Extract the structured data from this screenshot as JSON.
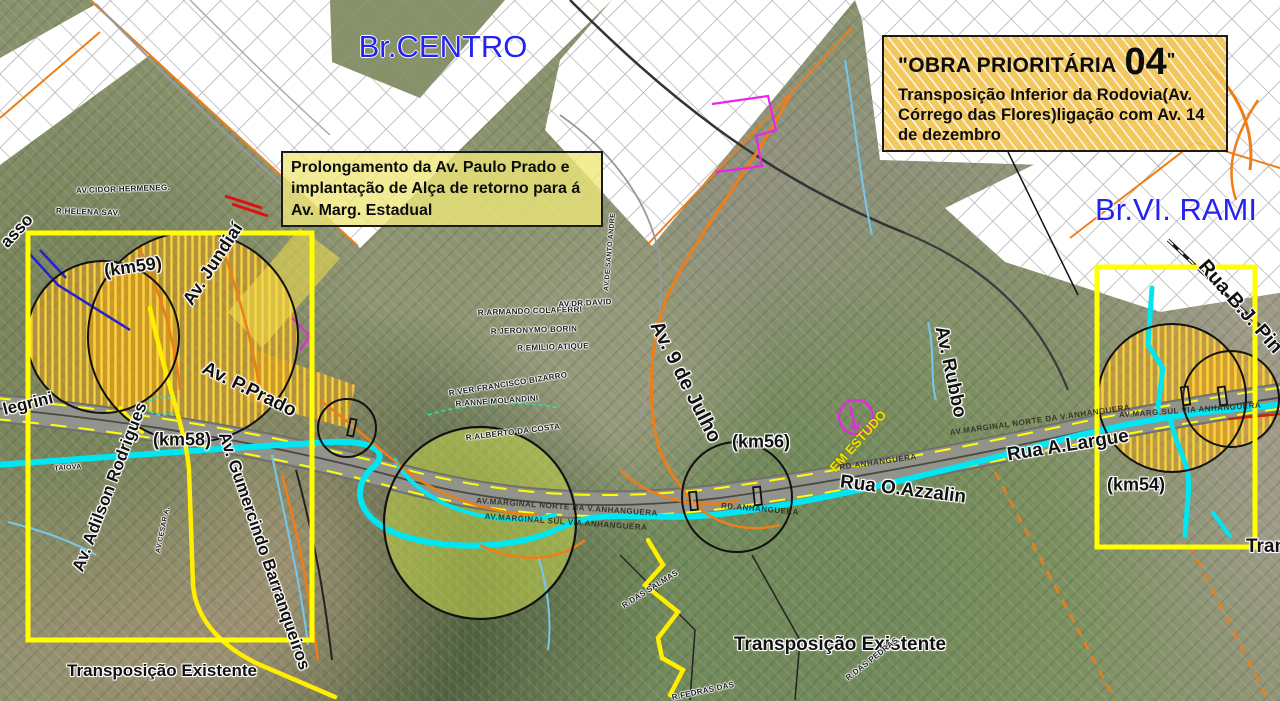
{
  "map": {
    "callouts": {
      "obra04": {
        "title_prefix": "\"OBRA PRIORITÁRIA",
        "number": "04",
        "title_suffix": "\"",
        "body": "Transposição Inferior da Rodovia(Av. Córrego das Flores)ligação com Av. 14 de dezembro"
      },
      "prolongamento": {
        "body": "Prolongamento da Av. Paulo Prado e implantação de Alça de retorno para á Av. Marg. Estadual"
      }
    },
    "labels": [
      {
        "name": "region-label-centro",
        "text": "Br.CENTRO",
        "x": 443,
        "y": 47,
        "rot": 0,
        "size": 31,
        "color": "#2424ee",
        "cls": "region"
      },
      {
        "name": "region-label-vila-rami",
        "text": "Br.VI. RAMI",
        "x": 1176,
        "y": 210,
        "rot": 0,
        "size": 31,
        "color": "#2424ee",
        "cls": "region"
      },
      {
        "name": "road-label-av-jundiai",
        "text": "Av. Jundiaí",
        "x": 213,
        "y": 264,
        "rot": -57,
        "size": 18
      },
      {
        "name": "km-marker-59",
        "text": "(km59)",
        "x": 133,
        "y": 267,
        "rot": -8,
        "size": 18
      },
      {
        "name": "km-marker-58",
        "text": "(km58)",
        "x": 182,
        "y": 440,
        "rot": 0,
        "size": 18
      },
      {
        "name": "road-label-av-p-prado",
        "text": "Av. P.Prado",
        "x": 249,
        "y": 390,
        "rot": 26,
        "size": 19
      },
      {
        "name": "road-label-av-adilson-rodrigues",
        "text": "Av. Adilson Rodrigues",
        "x": 110,
        "y": 487,
        "rot": -69,
        "size": 17
      },
      {
        "name": "road-label-av-gumercindo-barranqueiros",
        "text": "Av. Gumercindo Barranqueiros",
        "x": 264,
        "y": 551,
        "rot": 71,
        "size": 17
      },
      {
        "name": "note-transposicao-existente-left",
        "text": "Transposição Existente",
        "x": 162,
        "y": 671,
        "rot": 0,
        "size": 17
      },
      {
        "name": "road-label-av-9-de-julho",
        "text": "Av. 9 de Julho",
        "x": 685,
        "y": 382,
        "rot": 63,
        "size": 20
      },
      {
        "name": "km-marker-56",
        "text": "(km56)",
        "x": 761,
        "y": 442,
        "rot": 0,
        "size": 18
      },
      {
        "name": "note-em-estudo",
        "text": "EM ESTUDO",
        "x": 858,
        "y": 441,
        "rot": -48,
        "size": 13,
        "color": "#f2e400",
        "cls": "on-dark"
      },
      {
        "name": "road-label-av-rubbo",
        "text": "Av. Rubbo",
        "x": 950,
        "y": 372,
        "rot": 78,
        "size": 19
      },
      {
        "name": "road-label-rua-o-azzalin",
        "text": "Rua O.Azzalin",
        "x": 903,
        "y": 490,
        "rot": 7,
        "size": 19
      },
      {
        "name": "road-label-rua-a-largue",
        "text": "Rua A.Largue",
        "x": 1068,
        "y": 446,
        "rot": -9,
        "size": 19
      },
      {
        "name": "km-marker-54",
        "text": "(km54)",
        "x": 1136,
        "y": 485,
        "rot": 0,
        "size": 18
      },
      {
        "name": "road-label-rua-bj-pin",
        "text": "Rua B.J. Pin",
        "x": 1240,
        "y": 307,
        "rot": 49,
        "size": 20
      },
      {
        "name": "note-transposicao-existente-center",
        "text": "Transposição Existente",
        "x": 840,
        "y": 645,
        "rot": 0,
        "size": 19
      },
      {
        "name": "note-transposicao-right-clipped",
        "text": "Tran",
        "x": 1266,
        "y": 547,
        "rot": 0,
        "size": 19
      },
      {
        "name": "edge-label-asso",
        "text": "asso",
        "x": 17,
        "y": 231,
        "rot": -47,
        "size": 17
      },
      {
        "name": "edge-label-legrini",
        "text": "legrini",
        "x": 28,
        "y": 404,
        "rot": -14,
        "size": 17
      },
      {
        "name": "hwy-label-marginal-norte-left",
        "text": "AV.MARGINAL NORTE DA V.ANHANGUERA",
        "x": 567,
        "y": 507,
        "rot": 4,
        "size": 8,
        "cls": "hwy"
      },
      {
        "name": "hwy-label-marginal-sul-left",
        "text": "AV.MARGINAL SUL VIA ANHANGUERA",
        "x": 566,
        "y": 522,
        "rot": 4,
        "size": 8,
        "cls": "hwy"
      },
      {
        "name": "hwy-label-rd-anhanguera-1",
        "text": "RD.ANHANGUERA",
        "x": 878,
        "y": 462,
        "rot": -8,
        "size": 8,
        "cls": "hwy"
      },
      {
        "name": "hwy-label-rd-anhanguera-2",
        "text": "RD.ANHANGUERA",
        "x": 760,
        "y": 509,
        "rot": 5,
        "size": 8,
        "cls": "hwy"
      },
      {
        "name": "hwy-label-marginal-norte-right",
        "text": "AV.MARGINAL NORTE DA V.ANHANGUERA",
        "x": 1040,
        "y": 420,
        "rot": -8,
        "size": 8,
        "cls": "hwy"
      },
      {
        "name": "hwy-label-marginal-sul-right",
        "text": "AV.MARG.SUL VIA ANHANGUERA",
        "x": 1190,
        "y": 410,
        "rot": -4,
        "size": 8,
        "cls": "hwy"
      },
      {
        "name": "street-label-colaferri",
        "text": "R.ARMANDO COLAFERRI",
        "x": 530,
        "y": 311,
        "rot": -2,
        "size": 8,
        "cls": "tiny"
      },
      {
        "name": "street-label-jeronymo",
        "text": "R.JERONYMO BORIN",
        "x": 534,
        "y": 330,
        "rot": -2,
        "size": 8,
        "cls": "tiny"
      },
      {
        "name": "street-label-emilio-atique",
        "text": "R.EMILIO ATIQUE",
        "x": 553,
        "y": 347,
        "rot": -2,
        "size": 8,
        "cls": "tiny"
      },
      {
        "name": "street-label-francisco-bizarro",
        "text": "R.VER.FRANCISCO BIZARRO",
        "x": 508,
        "y": 384,
        "rot": -9,
        "size": 8,
        "cls": "tiny"
      },
      {
        "name": "street-label-anne-molandini",
        "text": "R.ANNE MOLANDINI",
        "x": 497,
        "y": 401,
        "rot": -4,
        "size": 8,
        "cls": "tiny"
      },
      {
        "name": "street-label-dr-david",
        "text": "AV.DR.DAVID",
        "x": 585,
        "y": 303,
        "rot": -3,
        "size": 8,
        "cls": "tiny"
      },
      {
        "name": "street-label-alberto-costa",
        "text": "R.ALBERTO DA COSTA",
        "x": 513,
        "y": 432,
        "rot": -7,
        "size": 8,
        "cls": "tiny"
      },
      {
        "name": "street-label-cidor-hermeneg",
        "text": "AV.CIDOR HERMENEG.",
        "x": 123,
        "y": 189,
        "rot": -2,
        "size": 8,
        "cls": "tiny"
      },
      {
        "name": "street-label-helena",
        "text": "R.HELENA SAV.",
        "x": 88,
        "y": 212,
        "rot": 2,
        "size": 8,
        "cls": "tiny"
      },
      {
        "name": "street-label-salmas",
        "text": "R.DAS SALMAS",
        "x": 650,
        "y": 589,
        "rot": -32,
        "size": 8,
        "cls": "tiny"
      },
      {
        "name": "street-label-pedras",
        "text": "R.DAS PEDRAS",
        "x": 872,
        "y": 659,
        "rot": -38,
        "size": 8,
        "cls": "tiny"
      },
      {
        "name": "street-label-fedras",
        "text": "R.FEDRAS DAS",
        "x": 703,
        "y": 691,
        "rot": -12,
        "size": 8,
        "cls": "tiny"
      },
      {
        "name": "street-label-taiova",
        "text": "TAIOVA",
        "x": 68,
        "y": 468,
        "rot": -4,
        "size": 7,
        "cls": "tiny"
      },
      {
        "name": "street-label-av-cesar",
        "text": "AV.CESAR A.",
        "x": 163,
        "y": 530,
        "rot": -78,
        "size": 7,
        "cls": "tiny"
      },
      {
        "name": "street-label-av-santo-andre",
        "text": "AV.DE SANTO ANDRE",
        "x": 610,
        "y": 252,
        "rot": -85,
        "size": 7,
        "cls": "tiny"
      }
    ],
    "colors": {
      "region_label": "#2424ee",
      "work_zone_fill": "#e6a720",
      "work_zone_hatch": "#fcd33c",
      "study_area_rect": "#ffff00",
      "river": "#00e6f2",
      "em_estudo_label": "#f2e400",
      "obra_callout_bg": "#f2c24e",
      "prolongamento_callout_bg": "#eee77a"
    }
  }
}
